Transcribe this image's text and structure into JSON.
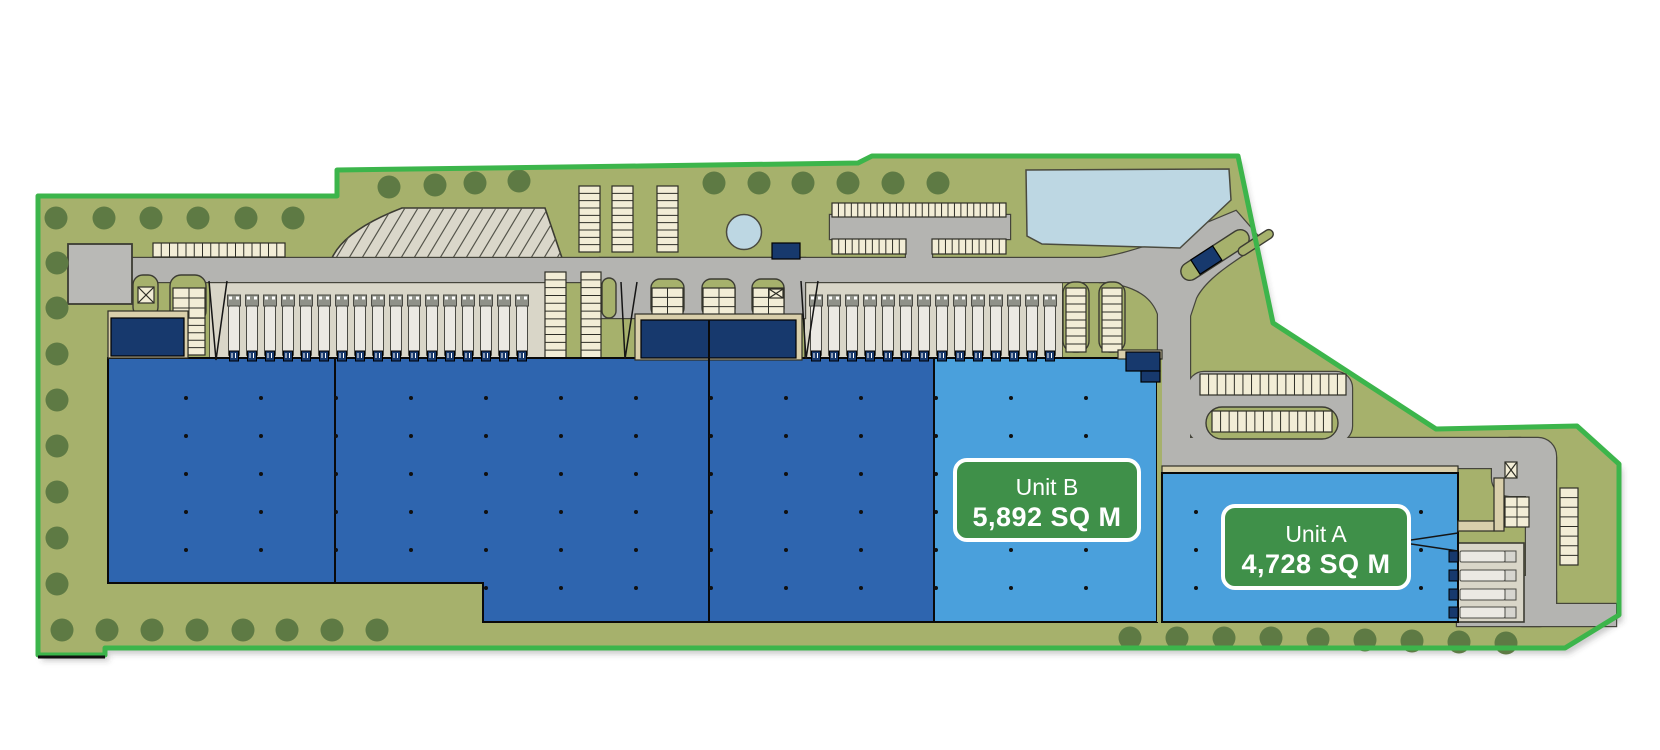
{
  "units": [
    {
      "name": "Unit B",
      "area": "5,892 SQ M"
    },
    {
      "name": "Unit A",
      "area": "4,728 SQ M"
    }
  ],
  "colors": {
    "available_unit_blue": "#4aa0dc",
    "existing_warehouse_blue": "#2e65af",
    "badge_green": "#3f9049",
    "boundary_green": "#3cb54b",
    "landscape_green": "#a6b16c",
    "water_blue": "#bdd7e3"
  }
}
